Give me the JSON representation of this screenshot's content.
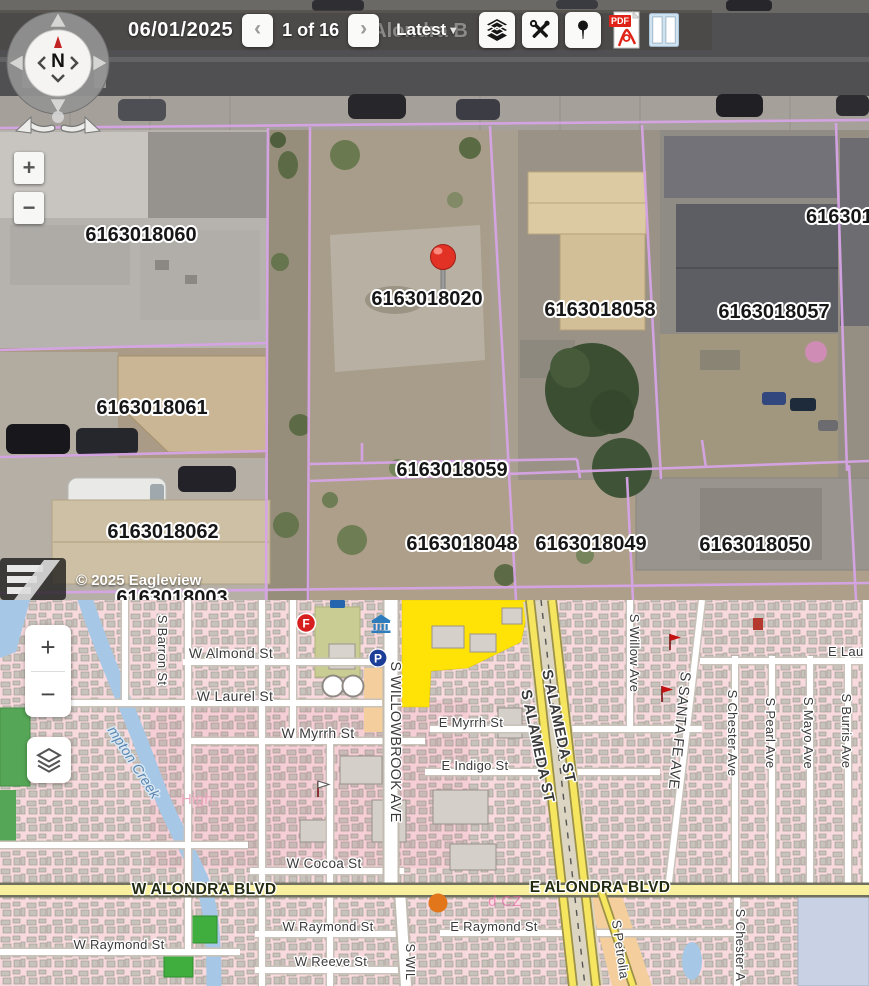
{
  "toolbar": {
    "date": "06/01/2025",
    "prev": "‹",
    "page_indicator": "1 of 16",
    "next": "›",
    "version": "Latest",
    "caret": "▾",
    "pdf_label": "PDF"
  },
  "aerial_view": {
    "copyright": "© 2025 Eagleview",
    "compass_label": "N",
    "zoom_in": "+",
    "zoom_out": "−",
    "pin": {
      "x": 443,
      "y": 258
    },
    "road_labels": [
      {
        "text": "Alondra B",
        "x": 420,
        "y": 37
      }
    ],
    "parcel_labels": [
      {
        "text": "6163018060",
        "x": 141,
        "y": 241
      },
      {
        "text": "616301",
        "x": 806,
        "y": 223,
        "anchor": "start"
      },
      {
        "text": "6163018020",
        "x": 427,
        "y": 305
      },
      {
        "text": "6163018058",
        "x": 600,
        "y": 316
      },
      {
        "text": "6163018057",
        "x": 774,
        "y": 318
      },
      {
        "text": "6163018061",
        "x": 152,
        "y": 414
      },
      {
        "text": "6163018059",
        "x": 452,
        "y": 476
      },
      {
        "text": "6163018062",
        "x": 163,
        "y": 538
      },
      {
        "text": "6163018048",
        "x": 462,
        "y": 550
      },
      {
        "text": "6163018049",
        "x": 591,
        "y": 550
      },
      {
        "text": "6163018050",
        "x": 755,
        "y": 551
      },
      {
        "text": "6163018003",
        "x": 172,
        "y": 604
      }
    ]
  },
  "street_map": {
    "zoom_in": "+",
    "zoom_out": "−",
    "labels": [
      {
        "text": "W Almond St",
        "x": 231,
        "y": 658,
        "size": 14
      },
      {
        "text": "W Laurel St",
        "x": 235,
        "y": 701,
        "size": 14
      },
      {
        "text": "W Myrrh St",
        "x": 318,
        "y": 738,
        "size": 14
      },
      {
        "text": "E Myrrh St",
        "x": 471,
        "y": 727,
        "size": 13
      },
      {
        "text": "E Indigo St",
        "x": 475,
        "y": 770,
        "size": 13
      },
      {
        "text": "E Lau",
        "x": 828,
        "y": 656,
        "size": 13,
        "anchor": "start"
      },
      {
        "text": "W Cocoa St",
        "x": 324,
        "y": 868,
        "size": 13.5
      },
      {
        "text": "W ALONDRA BLVD",
        "x": 204,
        "y": 894,
        "size": 15.5,
        "weight": "bold",
        "color": "#222a12"
      },
      {
        "text": "E ALONDRA BLVD",
        "x": 600,
        "y": 892,
        "size": 15.5,
        "weight": "bold",
        "color": "#222a12"
      },
      {
        "text": "W Raymond St",
        "x": 119,
        "y": 949,
        "size": 13
      },
      {
        "text": "W Raymond St",
        "x": 328,
        "y": 931,
        "size": 13
      },
      {
        "text": "E Raymond St",
        "x": 494,
        "y": 931,
        "size": 13
      },
      {
        "text": "W Reeve St",
        "x": 331,
        "y": 966,
        "size": 13
      },
      {
        "text": "S Barron St",
        "x": 158,
        "y": 650,
        "rot": 90,
        "size": 13
      },
      {
        "text": "S WILLOWBROOK AVE",
        "x": 391,
        "y": 742,
        "rot": 90,
        "size": 14.5
      },
      {
        "text": "S WIL",
        "x": 406,
        "y": 962,
        "rot": 90,
        "size": 13
      },
      {
        "text": "S Willow Ave",
        "x": 630,
        "y": 653,
        "rot": 90,
        "size": 13
      },
      {
        "text": "S SANTA FE AVE",
        "x": 675,
        "y": 730,
        "rot": 96,
        "size": 14.5
      },
      {
        "text": "S Chester Ave",
        "x": 728,
        "y": 733,
        "rot": 90,
        "size": 13
      },
      {
        "text": "S Pearl Ave",
        "x": 766,
        "y": 733,
        "rot": 90,
        "size": 13
      },
      {
        "text": "S Mayo Ave",
        "x": 804,
        "y": 733,
        "rot": 90,
        "size": 13
      },
      {
        "text": "S Burris Ave",
        "x": 842,
        "y": 731,
        "rot": 90,
        "size": 13
      },
      {
        "text": "S Chester A",
        "x": 736,
        "y": 945,
        "rot": 90,
        "size": 13
      },
      {
        "text": "S Petrolia",
        "x": 616,
        "y": 950,
        "rot": 82,
        "size": 13
      },
      {
        "text": "S ALAMEDA ST",
        "x": 554,
        "y": 727,
        "rot": 78,
        "size": 15,
        "weight": "bold"
      },
      {
        "text": "S ALAMEDA ST",
        "x": 533,
        "y": 747,
        "rot": 78,
        "size": 15,
        "weight": "bold"
      },
      {
        "text": "mpton Creek",
        "x": 130,
        "y": 765,
        "rot": 57,
        "size": 14,
        "italic": true,
        "color": "#5b85b0",
        "halo": "#d9e8f3"
      },
      {
        "text": "High",
        "x": 197,
        "y": 804,
        "size": 15,
        "color": "#eba7c0",
        "halo": "none"
      },
      {
        "text": "d CZ",
        "x": 505,
        "y": 906,
        "size": 15,
        "color": "rgba(232,90,160,0.6)",
        "halo": "none"
      }
    ],
    "poi_labels": [
      {
        "text": "F",
        "x": 306,
        "y": 627.5,
        "name": "fire-station-label"
      },
      {
        "text": "P",
        "x": 378,
        "y": 662.5,
        "name": "parking-label"
      }
    ]
  },
  "colors": {
    "parcel_line": "#d6a3e6",
    "pin_red": "#e23125",
    "fire_red": "#d81f1f",
    "parking_blue": "#1c3e99",
    "orange_marker": "#e2761b",
    "creek_blue": "#a6c8e6",
    "park_green": "#3fae3f",
    "commercial_yellow": "#ffe206"
  }
}
